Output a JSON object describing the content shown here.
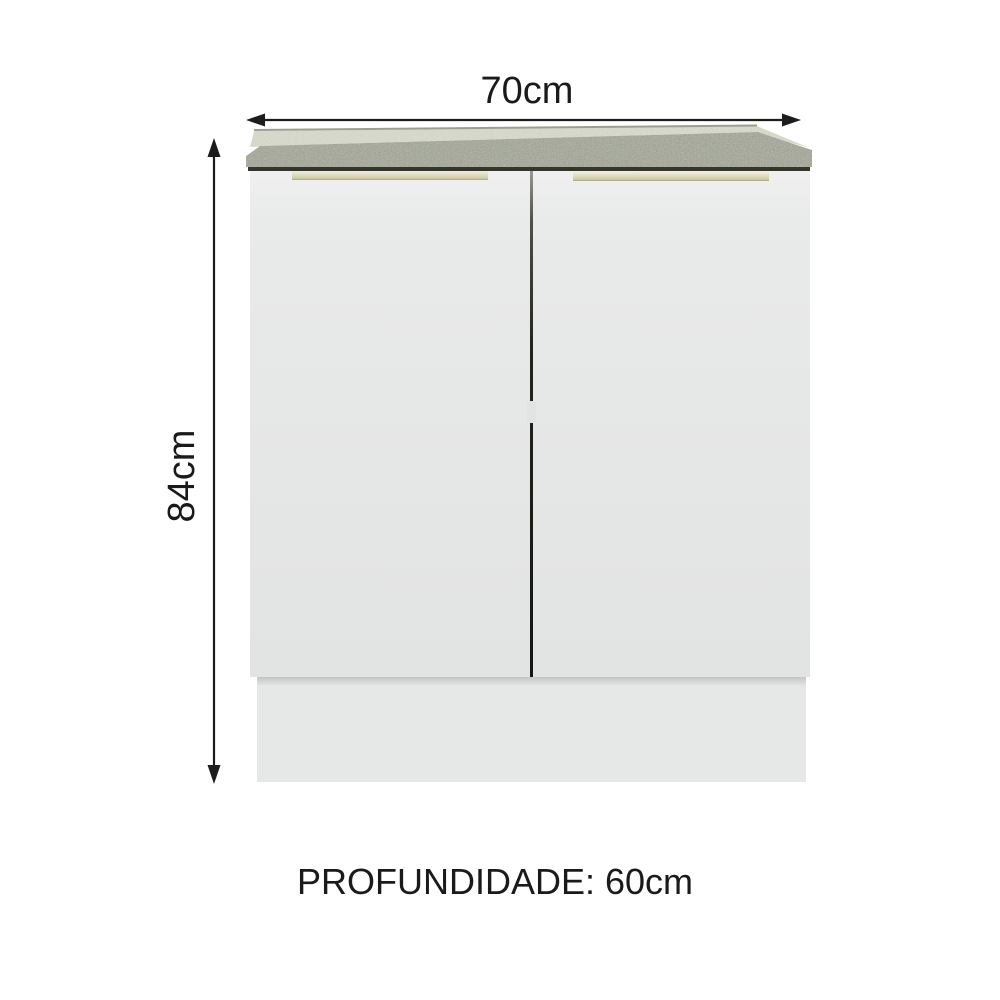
{
  "diagram": {
    "subject": "two-door kitchen base cabinet with countertop",
    "dimensions": {
      "width_label": "70cm",
      "height_label": "84cm",
      "depth_label": "PROFUNDIDADE: 60cm"
    },
    "measurements": {
      "width_cm": 70,
      "height_cm": 84,
      "depth_cm": 60
    }
  },
  "colors": {
    "background": "#ffffff",
    "text": "#1a1a1a",
    "dimension_line": "#1c1c1c",
    "countertop_base": "#a2a695",
    "countertop_top": "#dadcce",
    "countertop_back_edge": "#9ba08e",
    "countertop_shadow": "#34352b",
    "door": "#e5e6e6",
    "door_light": "#f0f0f0",
    "handle_light": "#efedda",
    "handle_mid": "#dedcbd",
    "handle_dark": "#a29f7c",
    "gap_dark": "#151513",
    "gap_light": "#9b9b98",
    "hinge_highlight": "#e2e3e3",
    "base_panel": "#e6e7e7"
  }
}
